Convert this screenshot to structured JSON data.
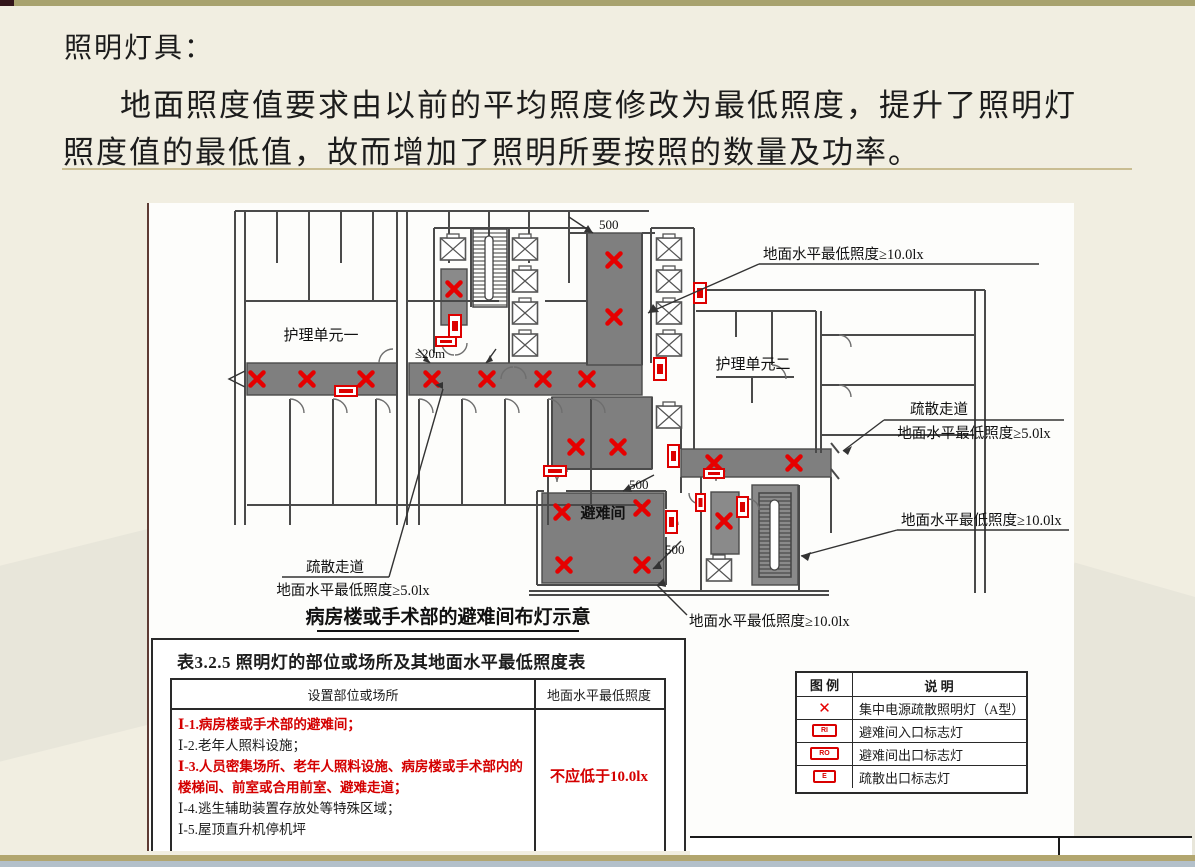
{
  "slide": {
    "title": "照明灯具：",
    "body_line1": "地面照度值要求由以前的平均照度修改为最低照度，提升了照明灯",
    "body_line2": "照度值的最低值，故而增加了照明所要按照的数量及功率。"
  },
  "plan": {
    "unit1": "护理单元一",
    "unit2": "护理单元二",
    "refuge": "避难间",
    "dim_20m": "≤20m",
    "dim_500_top": "500",
    "dim_500_refuge": "500",
    "dim_500_right": "500",
    "label_top": "地面水平最低照度≥10.0lx",
    "label_mid": "地面水平最低照度≥10.0lx",
    "label_bottom": "地面水平最低照度≥10.0lx",
    "corridor_right_1": "疏散走道",
    "corridor_right_2": "地面水平最低照度≥5.0lx",
    "corridor_left_1": "疏散走道",
    "corridor_left_2": "地面水平最低照度≥5.0lx",
    "caption": "病房楼或手术部的避难间布灯示意"
  },
  "table": {
    "title": "表3.2.5 照明灯的部位或场所及其地面水平最低照度表",
    "col1": "设置部位或场所",
    "col2": "地面水平最低照度",
    "rows": [
      {
        "text": "Ⅰ-1.病房楼或手术部的避难间；"
      },
      {
        "text": "Ⅰ-2.老年人照料设施；"
      },
      {
        "text": "Ⅰ-3.人员密集场所、老年人照料设施、病房楼或手术部内的楼梯间、前室或合用前室、避难走道；"
      },
      {
        "text": "Ⅰ-4.逃生辅助装置存放处等特殊区域；"
      },
      {
        "text": "Ⅰ-5.屋顶直升机停机坪"
      }
    ],
    "requirement": "不应低于10.0lx"
  },
  "legend": {
    "col1": "图 例",
    "col2": "说 明",
    "lamp_glyph": "✕",
    "rows": [
      {
        "text": "集中电源疏散照明灯（A型）"
      },
      {
        "badge": "RI",
        "text": "避难间入口标志灯"
      },
      {
        "badge": "RO",
        "text": "避难间出口标志灯"
      },
      {
        "badge": "E",
        "text": "疏散出口标志灯"
      }
    ]
  },
  "colors": {
    "accent_red": "#e60000",
    "corridor_gray": "#7f7f7f",
    "top_bar": "#a8a26e",
    "bottom_bar": "#b3c0ca",
    "background": "#f1eee1"
  }
}
